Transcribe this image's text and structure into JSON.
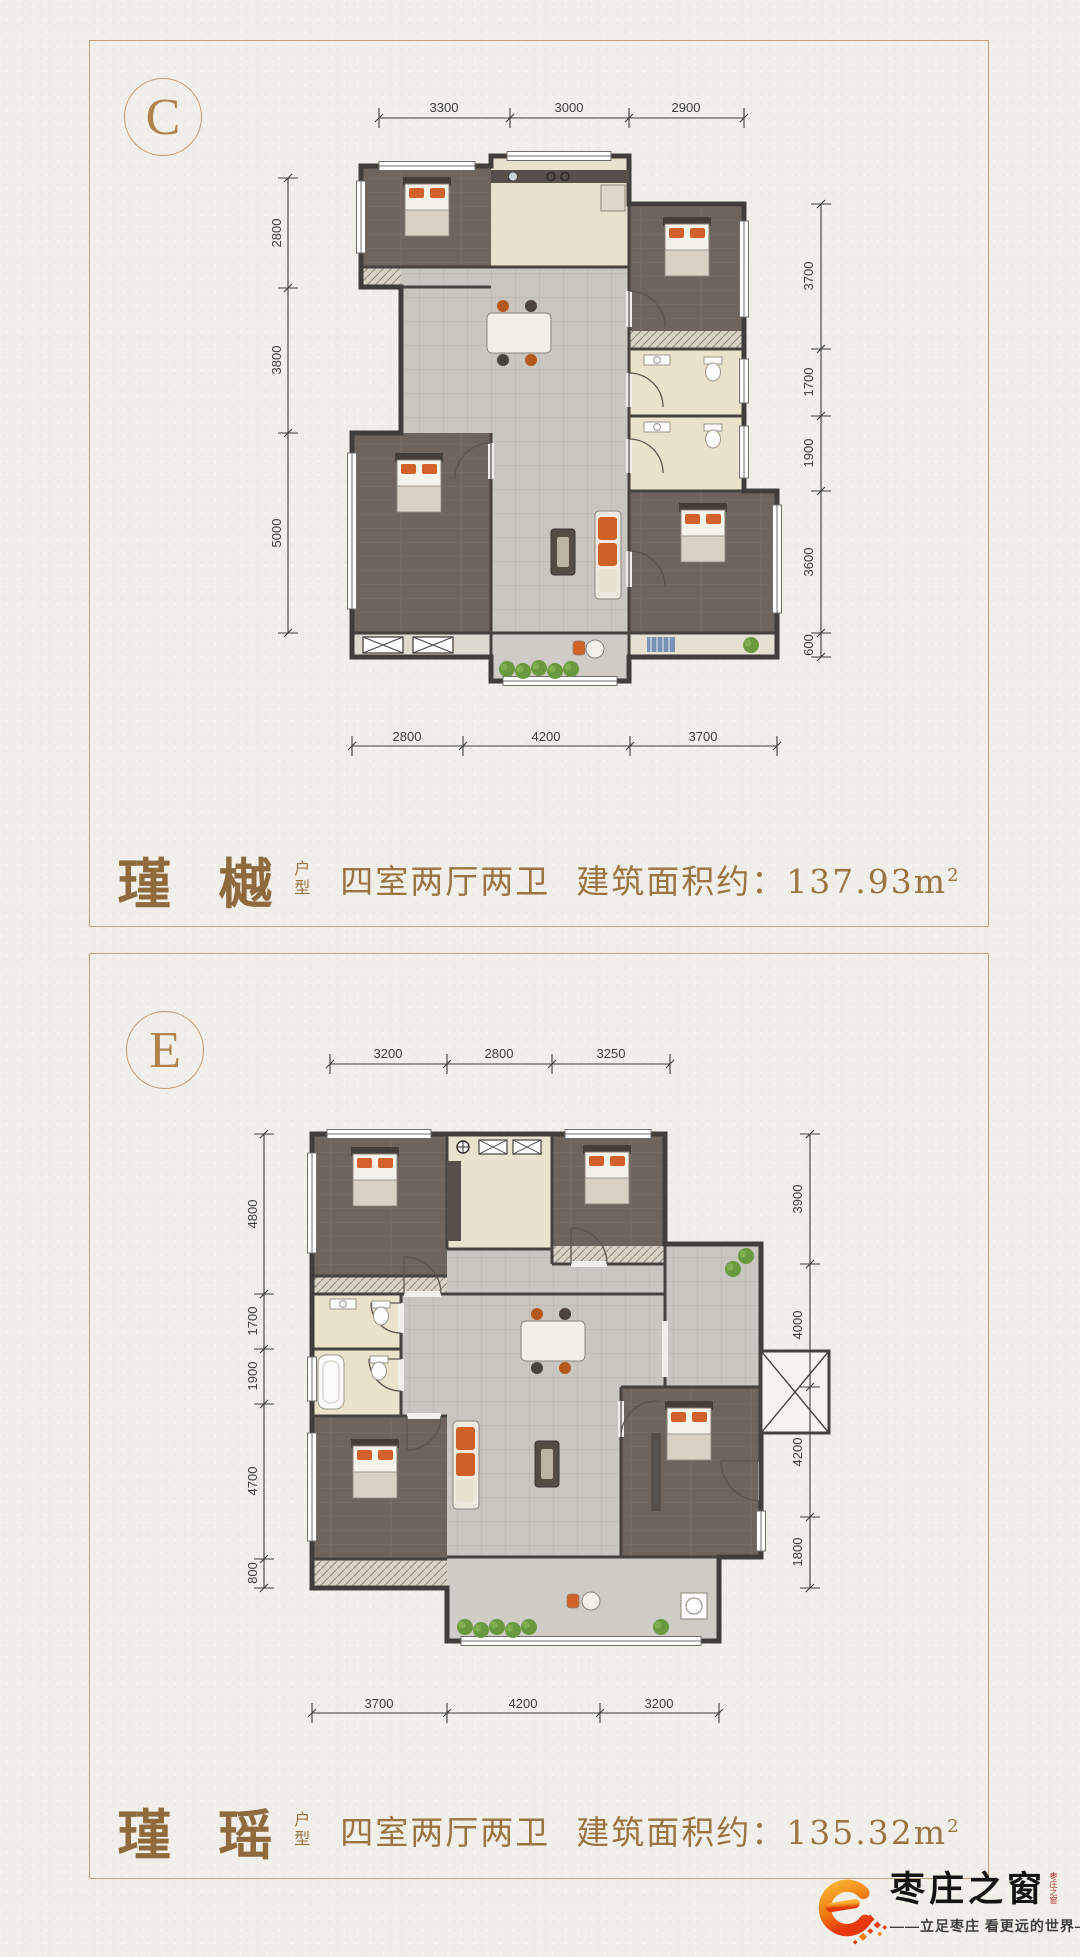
{
  "panels": [
    {
      "badge": "C",
      "name": "瑾 樾",
      "type_vertical": "户型",
      "rooms": "四室两厅两卫",
      "area_label": "建筑面积约：",
      "area": "137.93m",
      "area_exp": "2",
      "dims": {
        "top": [
          "3300",
          "3000",
          "2900"
        ],
        "bottom": [
          "2800",
          "4200",
          "3700"
        ],
        "left": [
          "2800",
          "3800",
          "5000"
        ],
        "right": [
          "3700",
          "1700",
          "1900",
          "3600",
          "600"
        ]
      }
    },
    {
      "badge": "E",
      "name": "瑾 瑶",
      "type_vertical": "户型",
      "rooms": "四室两厅两卫",
      "area_label": "建筑面积约：",
      "area": "135.32m",
      "area_exp": "2",
      "dims": {
        "top": [
          "3200",
          "2800",
          "3250"
        ],
        "bottom": [
          "3700",
          "4200",
          "3200"
        ],
        "left": [
          "4800",
          "1700",
          "1900",
          "4700",
          "800"
        ],
        "right": [
          "3900",
          "4000",
          "4200",
          "1800"
        ]
      }
    }
  ],
  "footer": {
    "brand": "枣庄之窗",
    "tagline": "——立足枣庄  看更远的世界——",
    "seal": "枣庄之窗"
  },
  "colors": {
    "accent_bronze": "#9a7443",
    "border_tan": "#c59e76",
    "logo_orange": "#f08300",
    "logo_red": "#e8380d",
    "dim_ink": "#3c3c3c"
  }
}
